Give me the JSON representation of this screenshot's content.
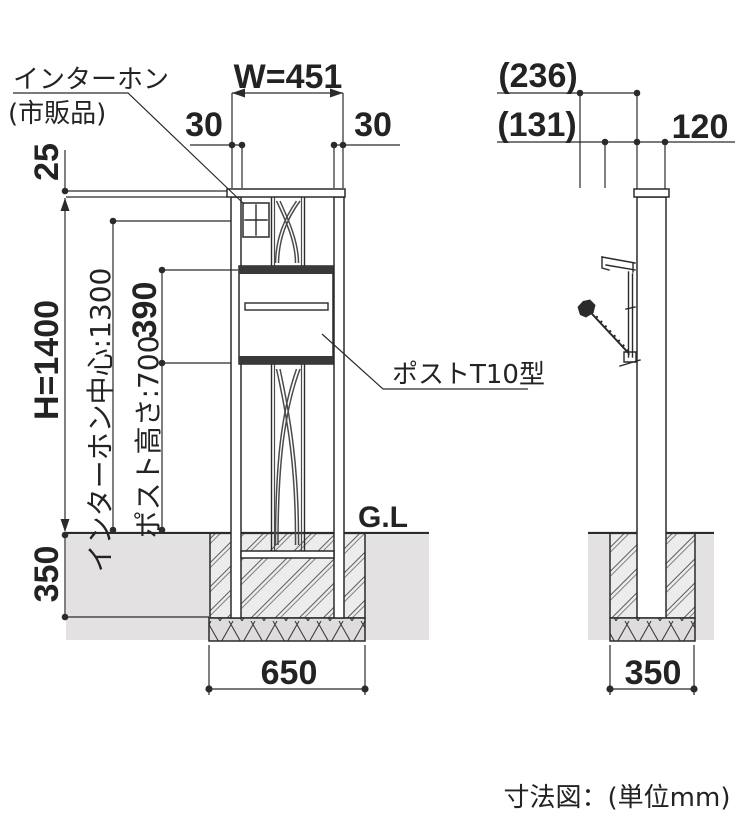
{
  "drawing": {
    "footer_caption": "寸法図：(単位mm)",
    "front_view": {
      "intercom_label_line1": "インターホン",
      "intercom_label_line2": "(市販品)",
      "post_label": "ポストT10型",
      "ground_line_label": "G.L",
      "dim_width": "W=451",
      "dim_margin_left": "30",
      "dim_margin_right": "30",
      "dim_cap_offset": "25",
      "dim_total_height": "H=1400",
      "dim_intercom_center": "インターホン中心:1300",
      "dim_post_box_height": "390",
      "dim_post_height": "ポスト高さ:700",
      "dim_embed_depth": "350",
      "dim_footing_width": "650"
    },
    "side_view": {
      "dim_overall_depth": "(236)",
      "dim_box_depth": "(131)",
      "dim_pillar_depth": "120",
      "dim_footing_width": "350"
    },
    "colors": {
      "line": "#2b2b2b",
      "soil": "#e3e1e1",
      "dark_band": "#39393b"
    }
  }
}
